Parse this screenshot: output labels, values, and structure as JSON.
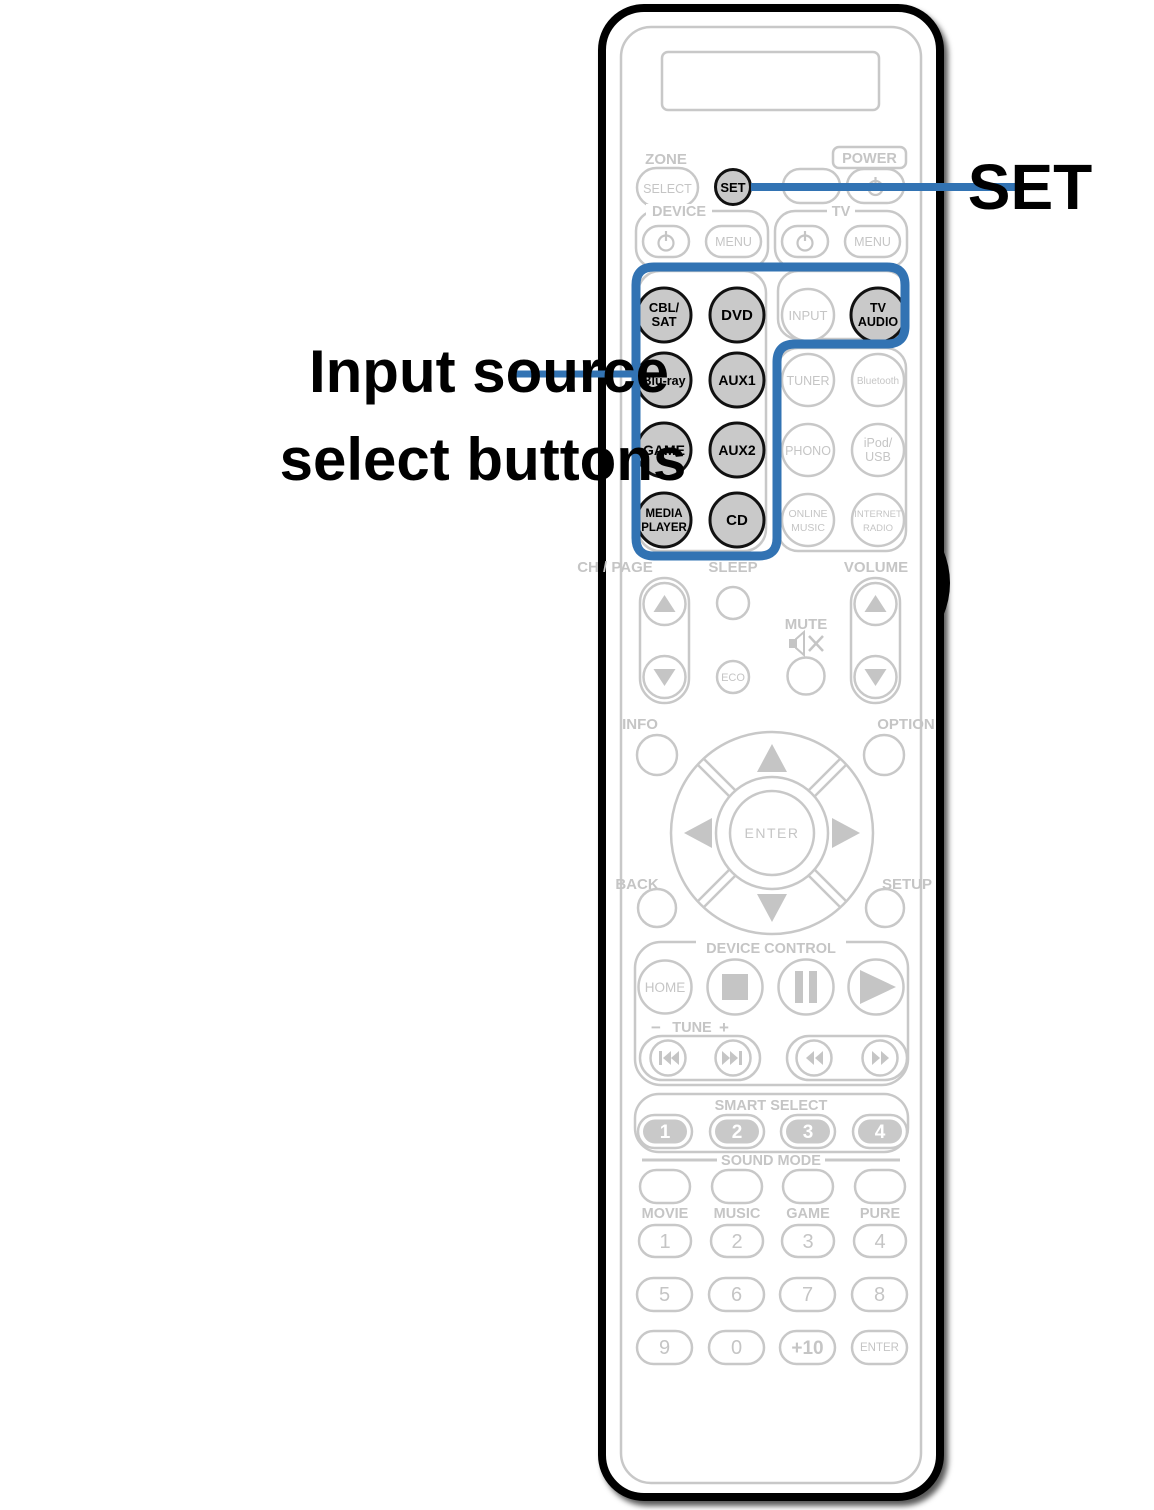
{
  "callouts": {
    "set_label": "SET",
    "input_line1": "Input source",
    "input_line2": "select buttons"
  },
  "colors": {
    "accent_blue": "#3273b3",
    "button_fill_gray": "#c9c9c9",
    "outline_gray": "#c8c8c8",
    "outline_black": "#000000"
  },
  "top": {
    "zone": "ZONE",
    "select": "SELECT",
    "set": "SET",
    "power": "POWER",
    "device": "DEVICE",
    "device_menu": "MENU",
    "tv": "TV",
    "tv_menu": "MENU"
  },
  "sources": {
    "cbl_sat_1": "CBL/",
    "cbl_sat_2": "SAT",
    "dvd": "DVD",
    "input": "INPUT",
    "tv_audio_1": "TV",
    "tv_audio_2": "AUDIO",
    "bluray": "Blu-ray",
    "aux1": "AUX1",
    "tuner": "TUNER",
    "bluetooth": "Bluetooth",
    "game": "GAME",
    "aux2": "AUX2",
    "phono": "PHONO",
    "ipod_1": "iPod/",
    "ipod_2": "USB",
    "media_1": "MEDIA",
    "media_2": "PLAYER",
    "cd": "CD",
    "online_1": "ONLINE",
    "online_2": "MUSIC",
    "inet_1": "INTERNET",
    "inet_2": "RADIO"
  },
  "mid": {
    "ch_page": "CH / PAGE",
    "sleep": "SLEEP",
    "volume": "VOLUME",
    "mute": "MUTE",
    "eco": "ECO",
    "info": "INFO",
    "option": "OPTION",
    "enter": "ENTER",
    "back": "BACK",
    "setup": "SETUP"
  },
  "transport": {
    "device_control": "DEVICE CONTROL",
    "home": "HOME",
    "tune_minus": "−",
    "tune": "TUNE",
    "tune_plus": "+"
  },
  "smart": {
    "label": "SMART SELECT",
    "b1": "1",
    "b2": "2",
    "b3": "3",
    "b4": "4"
  },
  "sound": {
    "label": "SOUND MODE",
    "movie": "MOVIE",
    "music": "MUSIC",
    "game": "GAME",
    "pure": "PURE"
  },
  "numpad": {
    "n1": "1",
    "n2": "2",
    "n3": "3",
    "n4": "4",
    "n5": "5",
    "n6": "6",
    "n7": "7",
    "n8": "8",
    "n9": "9",
    "n0": "0",
    "plus10": "+10",
    "enter": "ENTER"
  }
}
